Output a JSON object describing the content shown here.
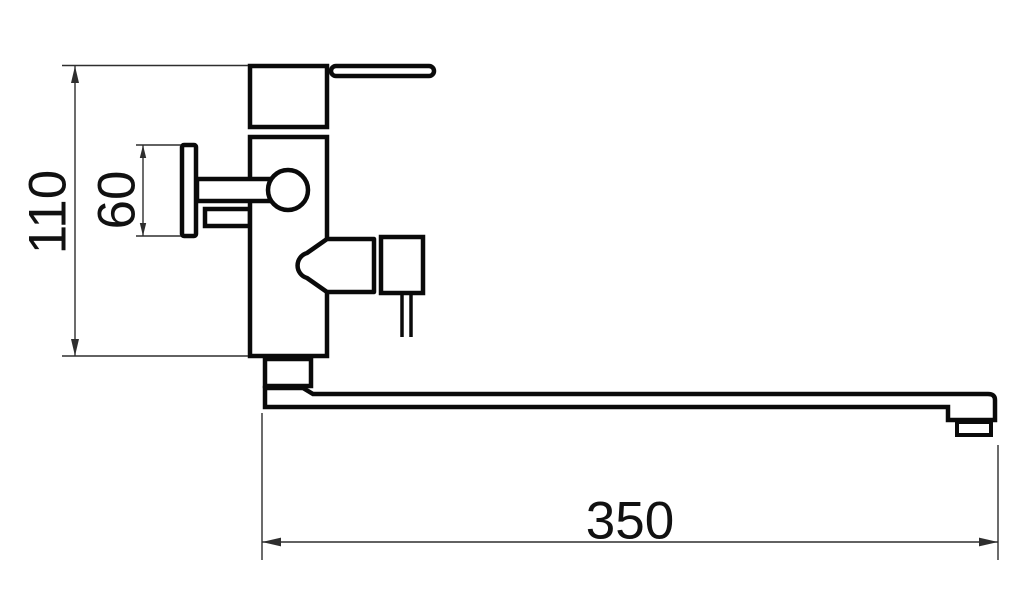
{
  "drawing": {
    "kind": "faucet-dimension-drawing"
  },
  "colors": {
    "bg": "#ffffff",
    "line": "#0a0a0a",
    "dim": "#2e2e2e",
    "text": "#111111"
  },
  "dimensions": {
    "height": "110",
    "connector": "60",
    "spout": "350"
  }
}
